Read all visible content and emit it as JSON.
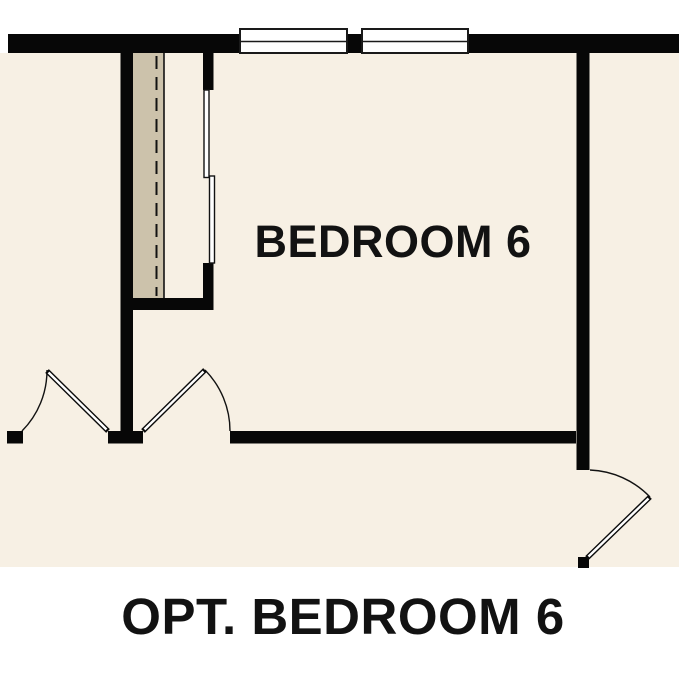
{
  "floor_plan": {
    "room_label": "BEDROOM 6",
    "caption": "OPT. BEDROOM 6",
    "colors": {
      "background": "#ffffff",
      "floor": "#f7f0e4",
      "wall": "#070707",
      "closet_shelf": "#ccc2ab",
      "window_fill": "#ffffff",
      "line": "#121212",
      "text": "#121212"
    }
  }
}
